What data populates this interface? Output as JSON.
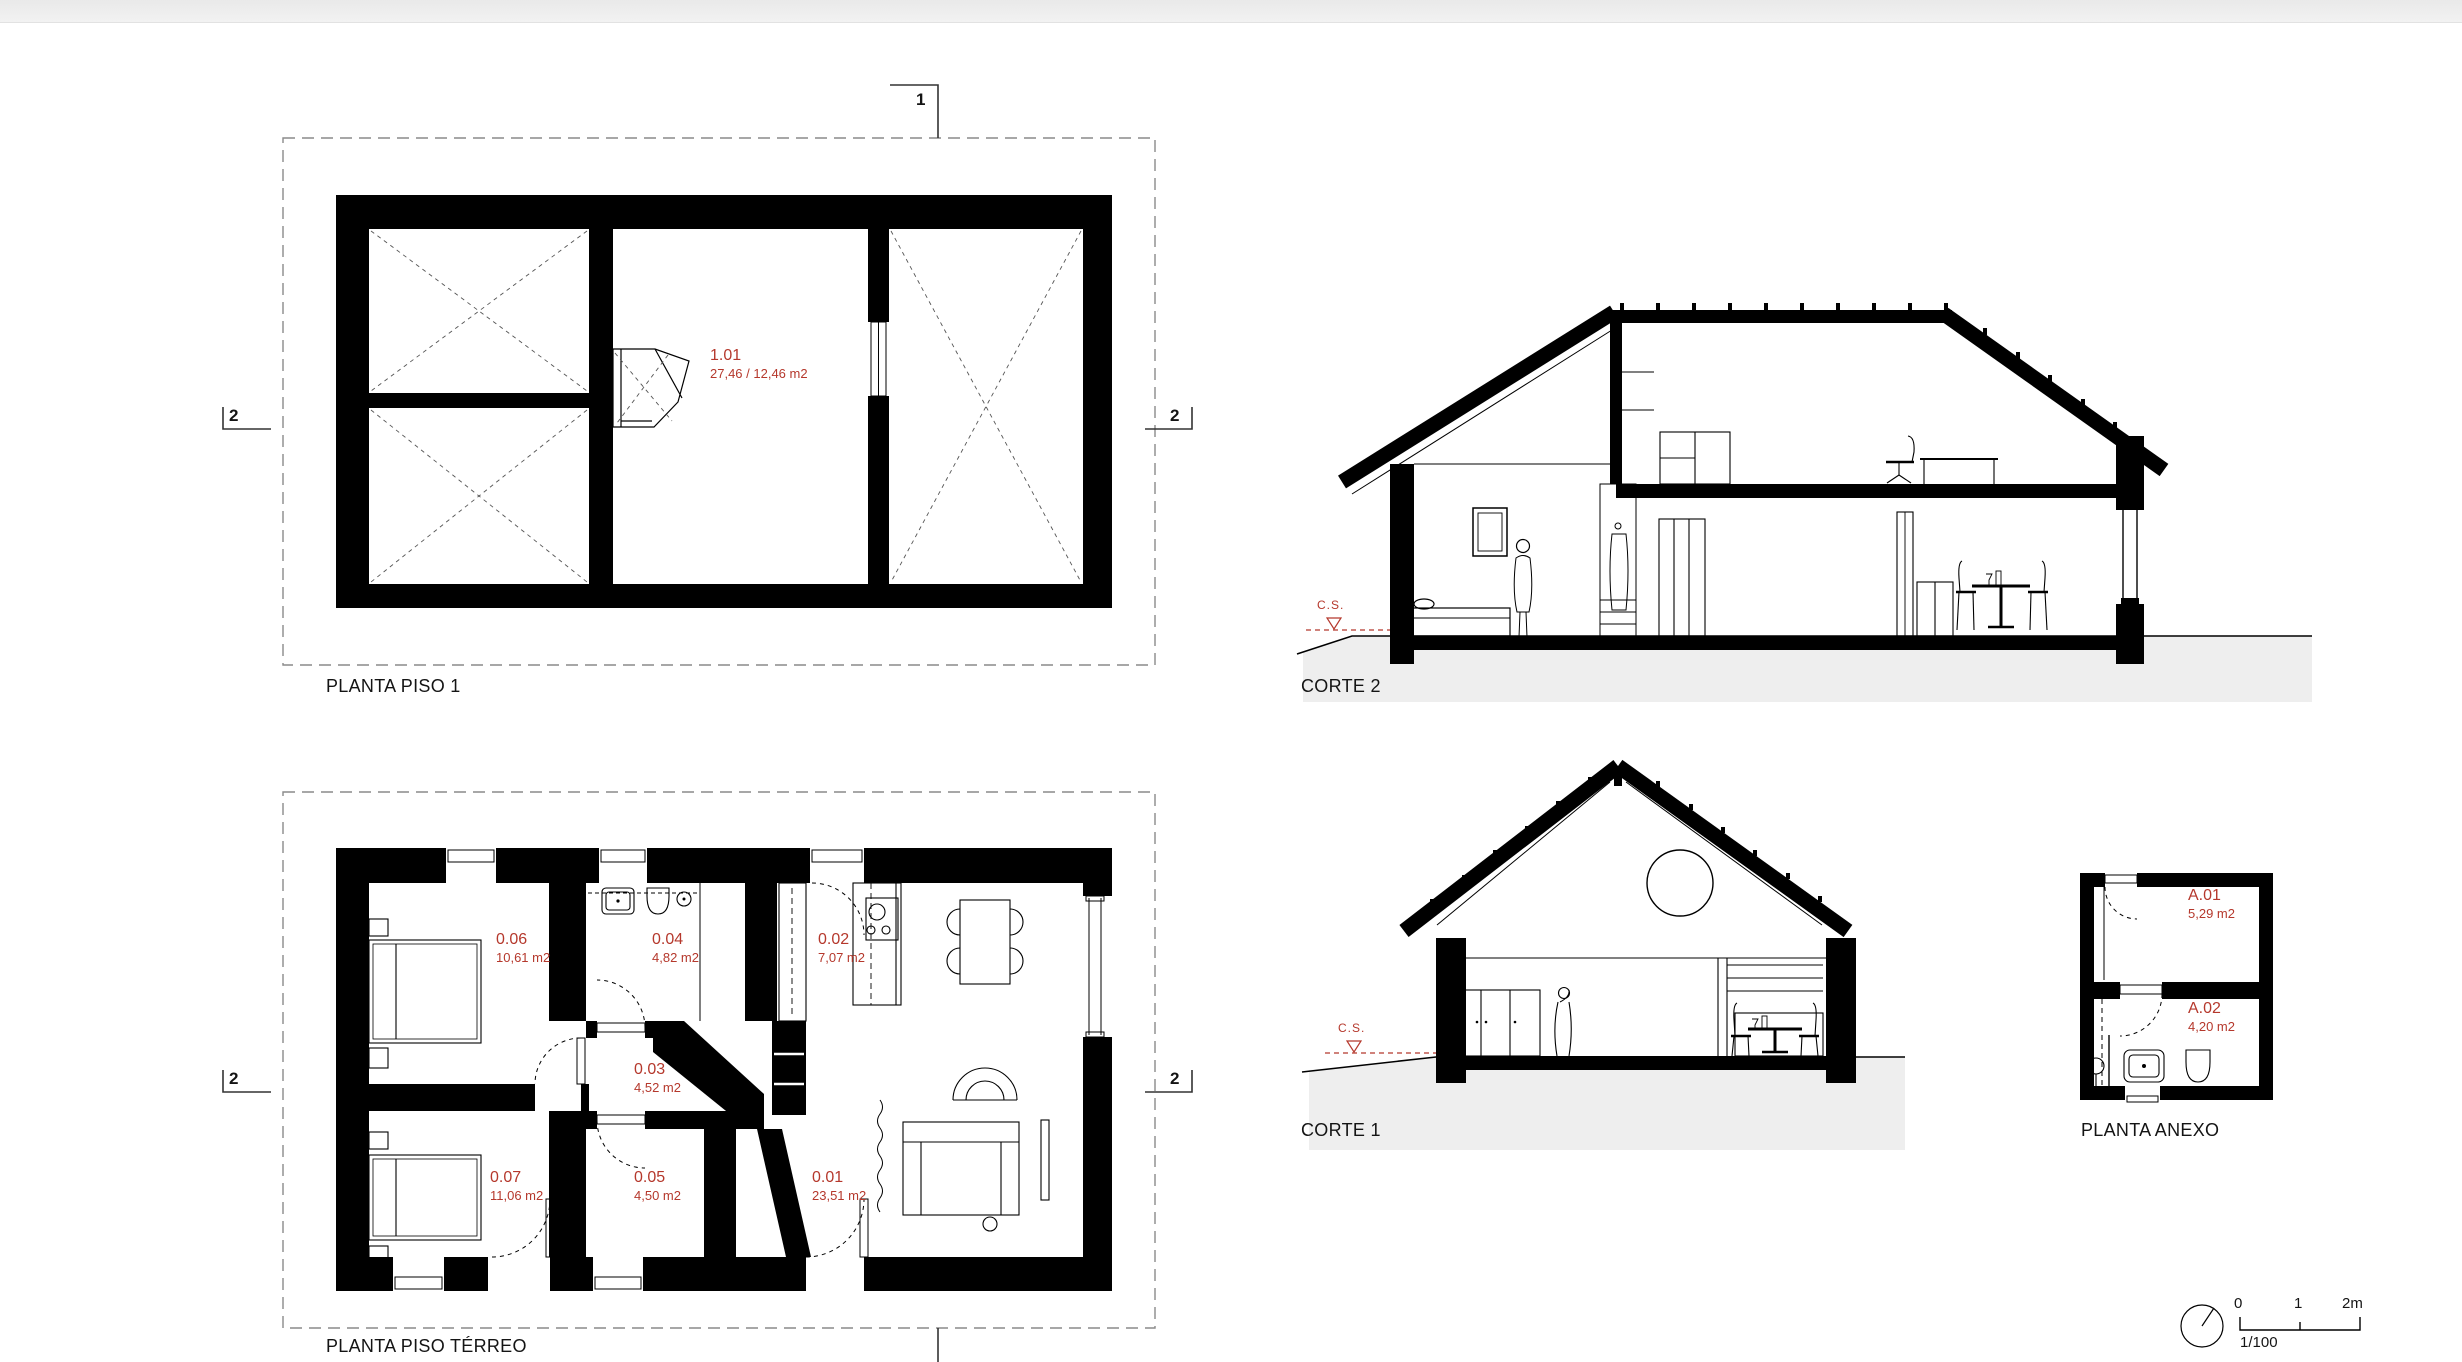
{
  "colors": {
    "accent_red": "#b5382c",
    "ink": "#000000",
    "ground_gray": "#eeeeee",
    "boundary_gray": "#8a8a8a",
    "top_strip": "#ececec"
  },
  "plans": {
    "piso1": {
      "title": "PLANTA PISO 1",
      "rooms": [
        {
          "code": "1.01",
          "area": "27,46 / 12,46 m2"
        }
      ]
    },
    "terreo": {
      "title": "PLANTA PISO TÉRREO",
      "rooms": [
        {
          "code": "0.06",
          "area": "10,61 m2"
        },
        {
          "code": "0.04",
          "area": "4,82 m2"
        },
        {
          "code": "0.02",
          "area": "7,07 m2"
        },
        {
          "code": "0.03",
          "area": "4,52 m2"
        },
        {
          "code": "0.07",
          "area": "11,06 m2"
        },
        {
          "code": "0.05",
          "area": "4,50 m2"
        },
        {
          "code": "0.01",
          "area": "23,51 m2"
        }
      ]
    },
    "anexo": {
      "title": "PLANTA ANEXO",
      "rooms": [
        {
          "code": "A.01",
          "area": "5,29 m2"
        },
        {
          "code": "A.02",
          "area": "4,20 m2"
        }
      ]
    }
  },
  "sections": {
    "corte2": {
      "title": "CORTE 2",
      "ground_marker": "C.S."
    },
    "corte1": {
      "title": "CORTE 1",
      "ground_marker": "C.S."
    }
  },
  "section_markers": {
    "line1": "1",
    "line2": "2"
  },
  "scale_bar": {
    "tick0": "0",
    "tick1": "1",
    "tick2": "2m",
    "ratio": "1/100"
  }
}
